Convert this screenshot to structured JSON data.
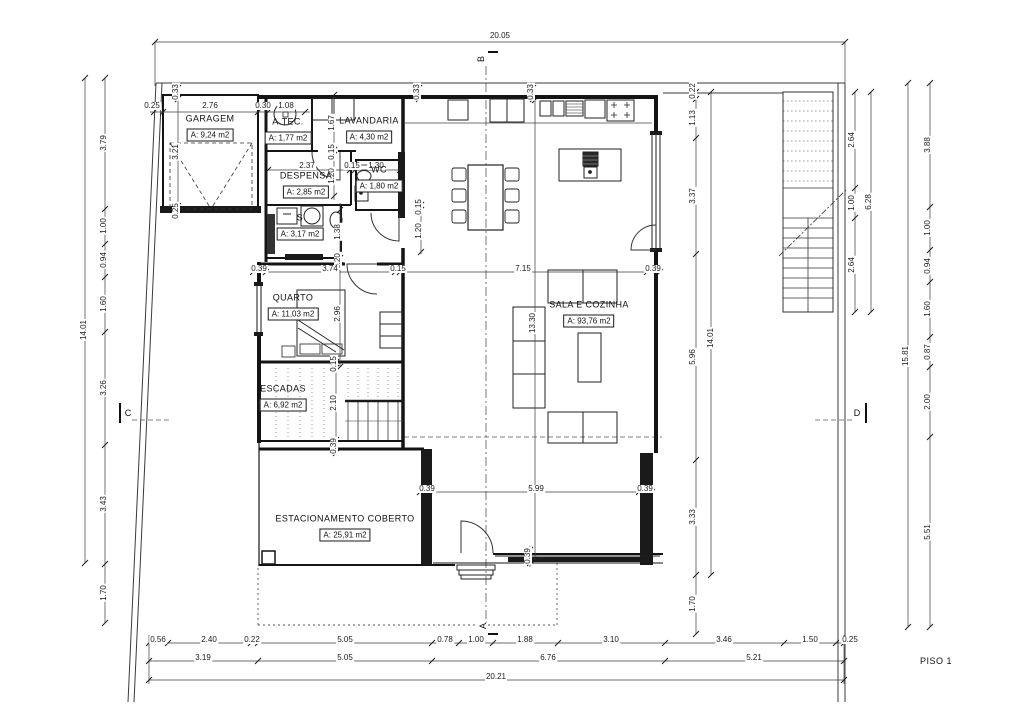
{
  "title": {
    "drawing_label": "PISO 1"
  },
  "colors": {
    "background": "#ffffff",
    "line": "#1a1a1a",
    "dim_text": "#1a1a1a"
  },
  "rooms": [
    {
      "id": "garagem",
      "name": "GARAGEM",
      "area": "A: 9,24 m2",
      "cx": 210,
      "cy": 128
    },
    {
      "id": "a-tec",
      "name": "A.TEC.",
      "area": "A: 1,77 m2",
      "cx": 288,
      "cy": 131
    },
    {
      "id": "lavandaria",
      "name": "LAVANDARIA",
      "area": "A: 4,30 m2",
      "cx": 369,
      "cy": 130
    },
    {
      "id": "despensa",
      "name": "DESPENSA",
      "area": "A: 2,85 m2",
      "cx": 306,
      "cy": 185
    },
    {
      "id": "wc",
      "name": "WC",
      "area": "A: 1,80 m2",
      "cx": 379,
      "cy": 179
    },
    {
      "id": "s",
      "name": "S",
      "area": "A: 3,17 m2",
      "cx": 300,
      "cy": 227
    },
    {
      "id": "quarto",
      "name": "QUARTO",
      "area": "A: 11,03 m2",
      "cx": 293,
      "cy": 307
    },
    {
      "id": "escadas",
      "name": "ESCADAS",
      "area": "A: 6,92 m2",
      "cx": 283,
      "cy": 398
    },
    {
      "id": "sala-e-cozinha",
      "name": "SALA E COZINHA",
      "area": "A: 93,76 m2",
      "cx": 589,
      "cy": 314
    },
    {
      "id": "estacionamento",
      "name": "ESTACIONAMENTO COBERTO",
      "area": "A: 25,91 m2",
      "cx": 345,
      "cy": 528
    }
  ],
  "section_markers": [
    {
      "letter": "B",
      "x": 481,
      "y": 59,
      "v": 1
    },
    {
      "letter": "A",
      "x": 483,
      "y": 626,
      "v": 1
    },
    {
      "letter": "C",
      "x": 128,
      "y": 413,
      "v": 0
    },
    {
      "letter": "D",
      "x": 857,
      "y": 413,
      "v": 0
    }
  ],
  "dimensions": [
    {
      "t": "20.05",
      "x": 500,
      "y": 36,
      "v": 0
    },
    {
      "t": "14.01",
      "x": 84,
      "y": 330,
      "v": 1
    },
    {
      "t": "3.79",
      "x": 104,
      "y": 143,
      "v": 1
    },
    {
      "t": "1.00",
      "x": 104,
      "y": 226,
      "v": 1
    },
    {
      "t": "0.94",
      "x": 104,
      "y": 260,
      "v": 1
    },
    {
      "t": "1.60",
      "x": 104,
      "y": 304,
      "v": 1
    },
    {
      "t": "3.26",
      "x": 104,
      "y": 388,
      "v": 1
    },
    {
      "t": "3.43",
      "x": 104,
      "y": 504,
      "v": 1
    },
    {
      "t": "1.70",
      "x": 104,
      "y": 593,
      "v": 1
    },
    {
      "t": "0.22",
      "x": 693,
      "y": 91,
      "v": 1
    },
    {
      "t": "1.13",
      "x": 693,
      "y": 118,
      "v": 1
    },
    {
      "t": "3.37",
      "x": 693,
      "y": 196,
      "v": 1
    },
    {
      "t": "5.96",
      "x": 693,
      "y": 357,
      "v": 1
    },
    {
      "t": "3.33",
      "x": 693,
      "y": 517,
      "v": 1
    },
    {
      "t": "1.70",
      "x": 693,
      "y": 604,
      "v": 1
    },
    {
      "t": "14.01",
      "x": 711,
      "y": 338,
      "v": 1
    },
    {
      "t": "2.64",
      "x": 852,
      "y": 140,
      "v": 1
    },
    {
      "t": "1.00",
      "x": 852,
      "y": 203,
      "v": 1
    },
    {
      "t": "2.64",
      "x": 852,
      "y": 265,
      "v": 1
    },
    {
      "t": "6.28",
      "x": 869,
      "y": 202,
      "v": 1
    },
    {
      "t": "3.88",
      "x": 928,
      "y": 145,
      "v": 1
    },
    {
      "t": "1.00",
      "x": 928,
      "y": 228,
      "v": 1
    },
    {
      "t": "0.94",
      "x": 928,
      "y": 266,
      "v": 1
    },
    {
      "t": "1.60",
      "x": 928,
      "y": 309,
      "v": 1
    },
    {
      "t": "0.87",
      "x": 928,
      "y": 352,
      "v": 1
    },
    {
      "t": "2.00",
      "x": 928,
      "y": 402,
      "v": 1
    },
    {
      "t": "5.51",
      "x": 928,
      "y": 532,
      "v": 1
    },
    {
      "t": "15.81",
      "x": 906,
      "y": 356,
      "v": 1
    },
    {
      "t": "0.56",
      "x": 158,
      "y": 640,
      "v": 0
    },
    {
      "t": "2.40",
      "x": 209,
      "y": 640,
      "v": 0
    },
    {
      "t": "0.22",
      "x": 252,
      "y": 640,
      "v": 0
    },
    {
      "t": "5.05",
      "x": 345,
      "y": 640,
      "v": 0
    },
    {
      "t": "0.78",
      "x": 445,
      "y": 640,
      "v": 0
    },
    {
      "t": "1.00",
      "x": 476,
      "y": 640,
      "v": 0
    },
    {
      "t": "1.88",
      "x": 525,
      "y": 640,
      "v": 0
    },
    {
      "t": "3.10",
      "x": 611,
      "y": 640,
      "v": 0
    },
    {
      "t": "3.46",
      "x": 724,
      "y": 640,
      "v": 0
    },
    {
      "t": "1.50",
      "x": 810,
      "y": 640,
      "v": 0
    },
    {
      "t": "0.25",
      "x": 850,
      "y": 640,
      "v": 0
    },
    {
      "t": "3.19",
      "x": 203,
      "y": 658,
      "v": 0
    },
    {
      "t": "5.05",
      "x": 345,
      "y": 658,
      "v": 0
    },
    {
      "t": "6.76",
      "x": 548,
      "y": 658,
      "v": 0
    },
    {
      "t": "5.21",
      "x": 754,
      "y": 658,
      "v": 0
    },
    {
      "t": "20.21",
      "x": 496,
      "y": 677,
      "v": 0
    },
    {
      "t": "0.25",
      "x": 152,
      "y": 106,
      "v": 0
    },
    {
      "t": "2.76",
      "x": 210,
      "y": 106,
      "v": 0
    },
    {
      "t": "0.30",
      "x": 263,
      "y": 106,
      "v": 0
    },
    {
      "t": "1.08",
      "x": 286,
      "y": 106,
      "v": 0
    },
    {
      "t": "0.33",
      "x": 176,
      "y": 92,
      "v": 1
    },
    {
      "t": "3.21",
      "x": 176,
      "y": 152,
      "v": 1
    },
    {
      "t": "0.25",
      "x": 176,
      "y": 211,
      "v": 1
    },
    {
      "t": "0.33",
      "x": 531,
      "y": 92,
      "v": 1
    },
    {
      "t": "0.33",
      "x": 417,
      "y": 92,
      "v": 1
    },
    {
      "t": "1.67",
      "x": 332,
      "y": 123,
      "v": 1
    },
    {
      "t": "0.15",
      "x": 332,
      "y": 152,
      "v": 1
    },
    {
      "t": "1.20",
      "x": 332,
      "y": 176,
      "v": 1
    },
    {
      "t": "2.37",
      "x": 307,
      "y": 166,
      "v": 0
    },
    {
      "t": "0.15",
      "x": 352,
      "y": 166,
      "v": 0
    },
    {
      "t": "1.30",
      "x": 376,
      "y": 166,
      "v": 0
    },
    {
      "t": "0.15",
      "x": 419,
      "y": 207,
      "v": 1
    },
    {
      "t": "1.20",
      "x": 419,
      "y": 231,
      "v": 1
    },
    {
      "t": "1.38",
      "x": 338,
      "y": 232,
      "v": 1
    },
    {
      "t": "0.20",
      "x": 338,
      "y": 261,
      "v": 1
    },
    {
      "t": "2.96",
      "x": 338,
      "y": 314,
      "v": 1
    },
    {
      "t": "0.39",
      "x": 259,
      "y": 269,
      "v": 0
    },
    {
      "t": "3.74",
      "x": 330,
      "y": 269,
      "v": 0
    },
    {
      "t": "0.15",
      "x": 398,
      "y": 269,
      "v": 0
    },
    {
      "t": "7.15",
      "x": 523,
      "y": 269,
      "v": 0
    },
    {
      "t": "0.39",
      "x": 653,
      "y": 269,
      "v": 0
    },
    {
      "t": "13.30",
      "x": 533,
      "y": 323,
      "v": 1
    },
    {
      "t": "0.15",
      "x": 334,
      "y": 364,
      "v": 1
    },
    {
      "t": "2.10",
      "x": 334,
      "y": 403,
      "v": 1
    },
    {
      "t": "0.39",
      "x": 334,
      "y": 446,
      "v": 1
    },
    {
      "t": "0.39",
      "x": 427,
      "y": 489,
      "v": 0
    },
    {
      "t": "5.99",
      "x": 536,
      "y": 489,
      "v": 0
    },
    {
      "t": "0.39",
      "x": 645,
      "y": 489,
      "v": 0
    },
    {
      "t": "0.39",
      "x": 528,
      "y": 556,
      "v": 1
    }
  ]
}
